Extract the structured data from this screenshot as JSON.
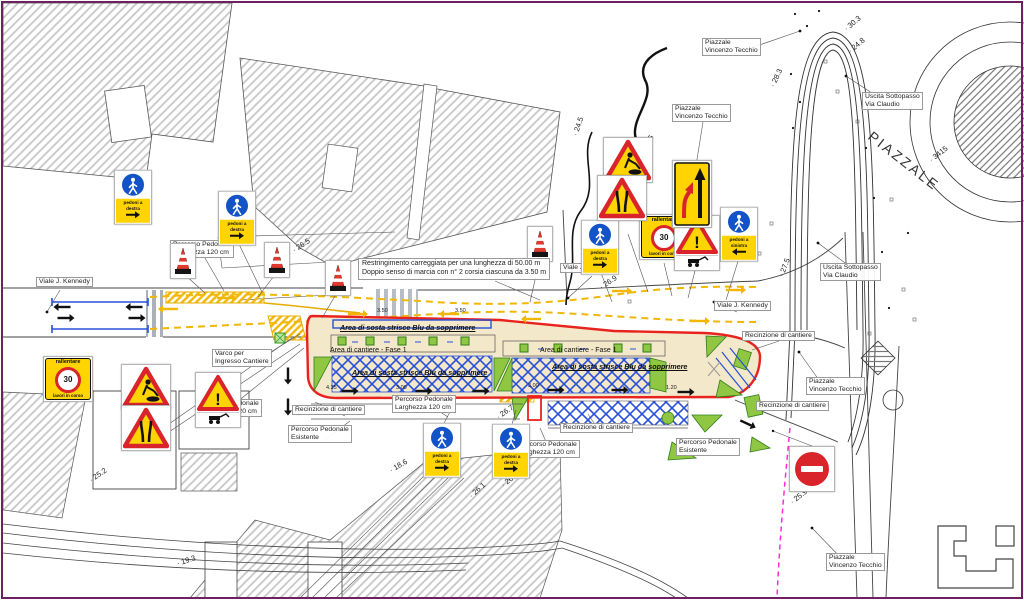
{
  "note": {
    "line1": "Restringimento carreggiata per una lunghezza di 50.00 m",
    "line2": "Doppio senso di marcia con n° 2 corsia ciascuna da 3.50 m"
  },
  "big_label": {
    "text": "PIAZZALE"
  },
  "labels": [
    {
      "t": [
        "Piazzale",
        "Vincenzo Tecchio"
      ],
      "x": 702,
      "y": 38,
      "style": "box"
    },
    {
      "t": [
        "Piazzale",
        "Vincenzo Tecchio"
      ],
      "x": 672,
      "y": 104,
      "style": "box"
    },
    {
      "t": [
        "Piazzale",
        "Vincenzo Tecchio"
      ],
      "x": 806,
      "y": 377,
      "style": "box"
    },
    {
      "t": [
        "Piazzale",
        "Vincenzo Tecchio"
      ],
      "x": 826,
      "y": 553,
      "style": "box"
    },
    {
      "t": [
        "Uscita Sottopasso",
        "Via Claudio"
      ],
      "x": 862,
      "y": 92,
      "style": "box"
    },
    {
      "t": [
        "Uscita Sottopasso",
        "Via Claudio"
      ],
      "x": 820,
      "y": 263,
      "style": "box"
    },
    {
      "t": [
        "Viale J. Kennedy"
      ],
      "x": 36,
      "y": 277,
      "style": "box"
    },
    {
      "t": [
        "Viale J. Kennedy"
      ],
      "x": 560,
      "y": 263,
      "style": "box"
    },
    {
      "t": [
        "Viale J. Kennedy"
      ],
      "x": 714,
      "y": 301,
      "style": "box"
    },
    {
      "t": [
        "Percorso Pedonale",
        "Larghezza 120 cm"
      ],
      "x": 170,
      "y": 240,
      "style": "box"
    },
    {
      "t": [
        "Percorso Pedonale",
        "Larghezza 120 cm"
      ],
      "x": 198,
      "y": 399,
      "style": "box"
    },
    {
      "t": [
        "Percorso Pedonale",
        "Larghezza 120 cm"
      ],
      "x": 392,
      "y": 395,
      "style": "box"
    },
    {
      "t": [
        "Percorso Pedonale",
        "Larghezza 120 cm"
      ],
      "x": 516,
      "y": 440,
      "style": "box"
    },
    {
      "t": [
        "Percorso Pedonale",
        "Esistente"
      ],
      "x": 288,
      "y": 425,
      "style": "box"
    },
    {
      "t": [
        "Percorso Pedonale",
        "Esistente"
      ],
      "x": 676,
      "y": 438,
      "style": "box"
    },
    {
      "t": [
        "Recinzione di cantiere"
      ],
      "x": 292,
      "y": 405,
      "style": "box"
    },
    {
      "t": [
        "Recinzione di cantiere"
      ],
      "x": 560,
      "y": 423,
      "style": "box"
    },
    {
      "t": [
        "Recinzione di cantiere"
      ],
      "x": 742,
      "y": 331,
      "style": "box"
    },
    {
      "t": [
        "Recinzione di cantiere"
      ],
      "x": 756,
      "y": 401,
      "style": "box"
    },
    {
      "t": [
        "Varco per",
        "Ingresso Cantiere"
      ],
      "x": 212,
      "y": 349,
      "style": "box"
    },
    {
      "t": [
        "Area di sosta strisce Blu da sopprimere"
      ],
      "x": 340,
      "y": 324,
      "style": "area"
    },
    {
      "t": [
        "Area di sosta strisce Blu da sopprimere"
      ],
      "x": 352,
      "y": 369,
      "style": "area"
    },
    {
      "t": [
        "Area di sosta strisce Blu da sopprimere"
      ],
      "x": 552,
      "y": 363,
      "style": "area"
    },
    {
      "t": [
        "Area di cantiere - Fase 1"
      ],
      "x": 330,
      "y": 347,
      "style": "plain"
    },
    {
      "t": [
        "Area di cantiere - Fase 1"
      ],
      "x": 540,
      "y": 347,
      "style": "plain"
    }
  ],
  "elevations": [
    {
      "v": "30.3",
      "x": 845,
      "y": 25,
      "rot": -40
    },
    {
      "v": "24.8",
      "x": 849,
      "y": 47,
      "rot": -40
    },
    {
      "v": "28.3",
      "x": 772,
      "y": 82,
      "rot": -65
    },
    {
      "v": "27.5",
      "x": 781,
      "y": 272,
      "rot": -70
    },
    {
      "v": "23.5",
      "x": 641,
      "y": 147,
      "rot": -55
    },
    {
      "v": "24.5",
      "x": 575,
      "y": 131,
      "rot": -72
    },
    {
      "v": "26.9",
      "x": 600,
      "y": 283,
      "rot": -33
    },
    {
      "v": "26.5",
      "x": 293,
      "y": 246,
      "rot": -33
    },
    {
      "v": "26.7",
      "x": 497,
      "y": 413,
      "rot": -35
    },
    {
      "v": "18.6",
      "x": 390,
      "y": 466,
      "rot": -30
    },
    {
      "v": "26.3",
      "x": 502,
      "y": 481,
      "rot": -38
    },
    {
      "v": "26.1",
      "x": 470,
      "y": 492,
      "rot": -42
    },
    {
      "v": "25.2",
      "x": 90,
      "y": 476,
      "rot": -35
    },
    {
      "v": "19.3",
      "x": 177,
      "y": 559,
      "rot": -18
    },
    {
      "v": "25.9",
      "x": 791,
      "y": 498,
      "rot": -38
    },
    {
      "v": "3415",
      "x": 930,
      "y": 156,
      "rot": -38
    }
  ],
  "dimensions": [
    {
      "v": "3.50",
      "x": 377,
      "y": 308
    },
    {
      "v": "3.50",
      "x": 455,
      "y": 308
    },
    {
      "v": "4.25",
      "x": 326,
      "y": 385
    },
    {
      "v": "3.00",
      "x": 396,
      "y": 385
    },
    {
      "v": "3.00",
      "x": 528,
      "y": 383
    },
    {
      "v": "1.20",
      "x": 666,
      "y": 385
    }
  ],
  "signs": {
    "ped": {
      "line1": "pedoni a",
      "destra": "destra",
      "sinistra": "sinistra"
    },
    "rallentare": {
      "top": "rallentare",
      "value": "30",
      "bottom": "lavori in corso"
    },
    "danger": {
      "mark": "!"
    }
  },
  "sign_placements": [
    {
      "t": "ped",
      "d": "destra",
      "x": 133,
      "y": 197
    },
    {
      "t": "ped",
      "d": "destra",
      "x": 237,
      "y": 218
    },
    {
      "t": "ped",
      "d": "destra",
      "x": 600,
      "y": 247
    },
    {
      "t": "ped",
      "d": "sinistra",
      "x": 739,
      "y": 234
    },
    {
      "t": "ped",
      "d": "destra",
      "x": 442,
      "y": 450
    },
    {
      "t": "ped",
      "d": "destra",
      "x": 511,
      "y": 451
    },
    {
      "t": "rall",
      "x": 68,
      "y": 379
    },
    {
      "t": "rall",
      "x": 664,
      "y": 237
    },
    {
      "t": "work",
      "x": 146,
      "y": 387
    },
    {
      "t": "work",
      "x": 628,
      "y": 160
    },
    {
      "t": "narrow",
      "x": 146,
      "y": 428
    },
    {
      "t": "narrow",
      "x": 622,
      "y": 198
    },
    {
      "t": "danger",
      "x": 218,
      "y": 400
    },
    {
      "t": "danger",
      "x": 697,
      "y": 243
    },
    {
      "t": "lane",
      "x": 692,
      "y": 194
    },
    {
      "t": "noentry",
      "x": 812,
      "y": 469
    },
    {
      "t": "cone",
      "x": 183,
      "y": 261
    },
    {
      "t": "cone",
      "x": 277,
      "y": 260
    },
    {
      "t": "cone",
      "x": 338,
      "y": 278
    },
    {
      "t": "cone",
      "x": 540,
      "y": 244
    }
  ],
  "traffic_arrows": [
    {
      "x": 168,
      "y": 309,
      "r": 180,
      "c": "y"
    },
    {
      "x": 227,
      "y": 298,
      "r": 0,
      "c": "y"
    },
    {
      "x": 358,
      "y": 314,
      "r": 0,
      "c": "y"
    },
    {
      "x": 449,
      "y": 314,
      "r": 180,
      "c": "y"
    },
    {
      "x": 531,
      "y": 319,
      "r": 180,
      "c": "y"
    },
    {
      "x": 622,
      "y": 291,
      "r": 0,
      "c": "y"
    },
    {
      "x": 700,
      "y": 321,
      "r": 0,
      "c": "y"
    },
    {
      "x": 736,
      "y": 290,
      "r": 0,
      "c": "y"
    },
    {
      "x": 62,
      "y": 307,
      "r": 180,
      "c": "k"
    },
    {
      "x": 134,
      "y": 307,
      "r": 180,
      "c": "k"
    },
    {
      "x": 66,
      "y": 318,
      "r": 0,
      "c": "k"
    },
    {
      "x": 137,
      "y": 318,
      "r": 0,
      "c": "k"
    },
    {
      "x": 350,
      "y": 391,
      "r": 0,
      "c": "k"
    },
    {
      "x": 424,
      "y": 391,
      "r": 0,
      "c": "k"
    },
    {
      "x": 481,
      "y": 391,
      "r": 0,
      "c": "k"
    },
    {
      "x": 556,
      "y": 390,
      "r": 0,
      "c": "k"
    },
    {
      "x": 620,
      "y": 390,
      "r": 0,
      "c": "k"
    },
    {
      "x": 686,
      "y": 392,
      "r": 0,
      "c": "k"
    },
    {
      "x": 288,
      "y": 376,
      "r": 90,
      "c": "k"
    },
    {
      "x": 288,
      "y": 407,
      "r": 90,
      "c": "k"
    },
    {
      "x": 748,
      "y": 424,
      "r": 25,
      "c": "k"
    }
  ],
  "colors": {
    "cantiere_fill": "#f4e8ca",
    "boundary_red": "#e8231d",
    "parking_blue": "#2850d8",
    "marking_yellow": "#f2b705",
    "sign_yellow": "#ffd400",
    "green": "#8fc742",
    "magenta": "#ff2bd6",
    "frame": "#6d2160"
  }
}
